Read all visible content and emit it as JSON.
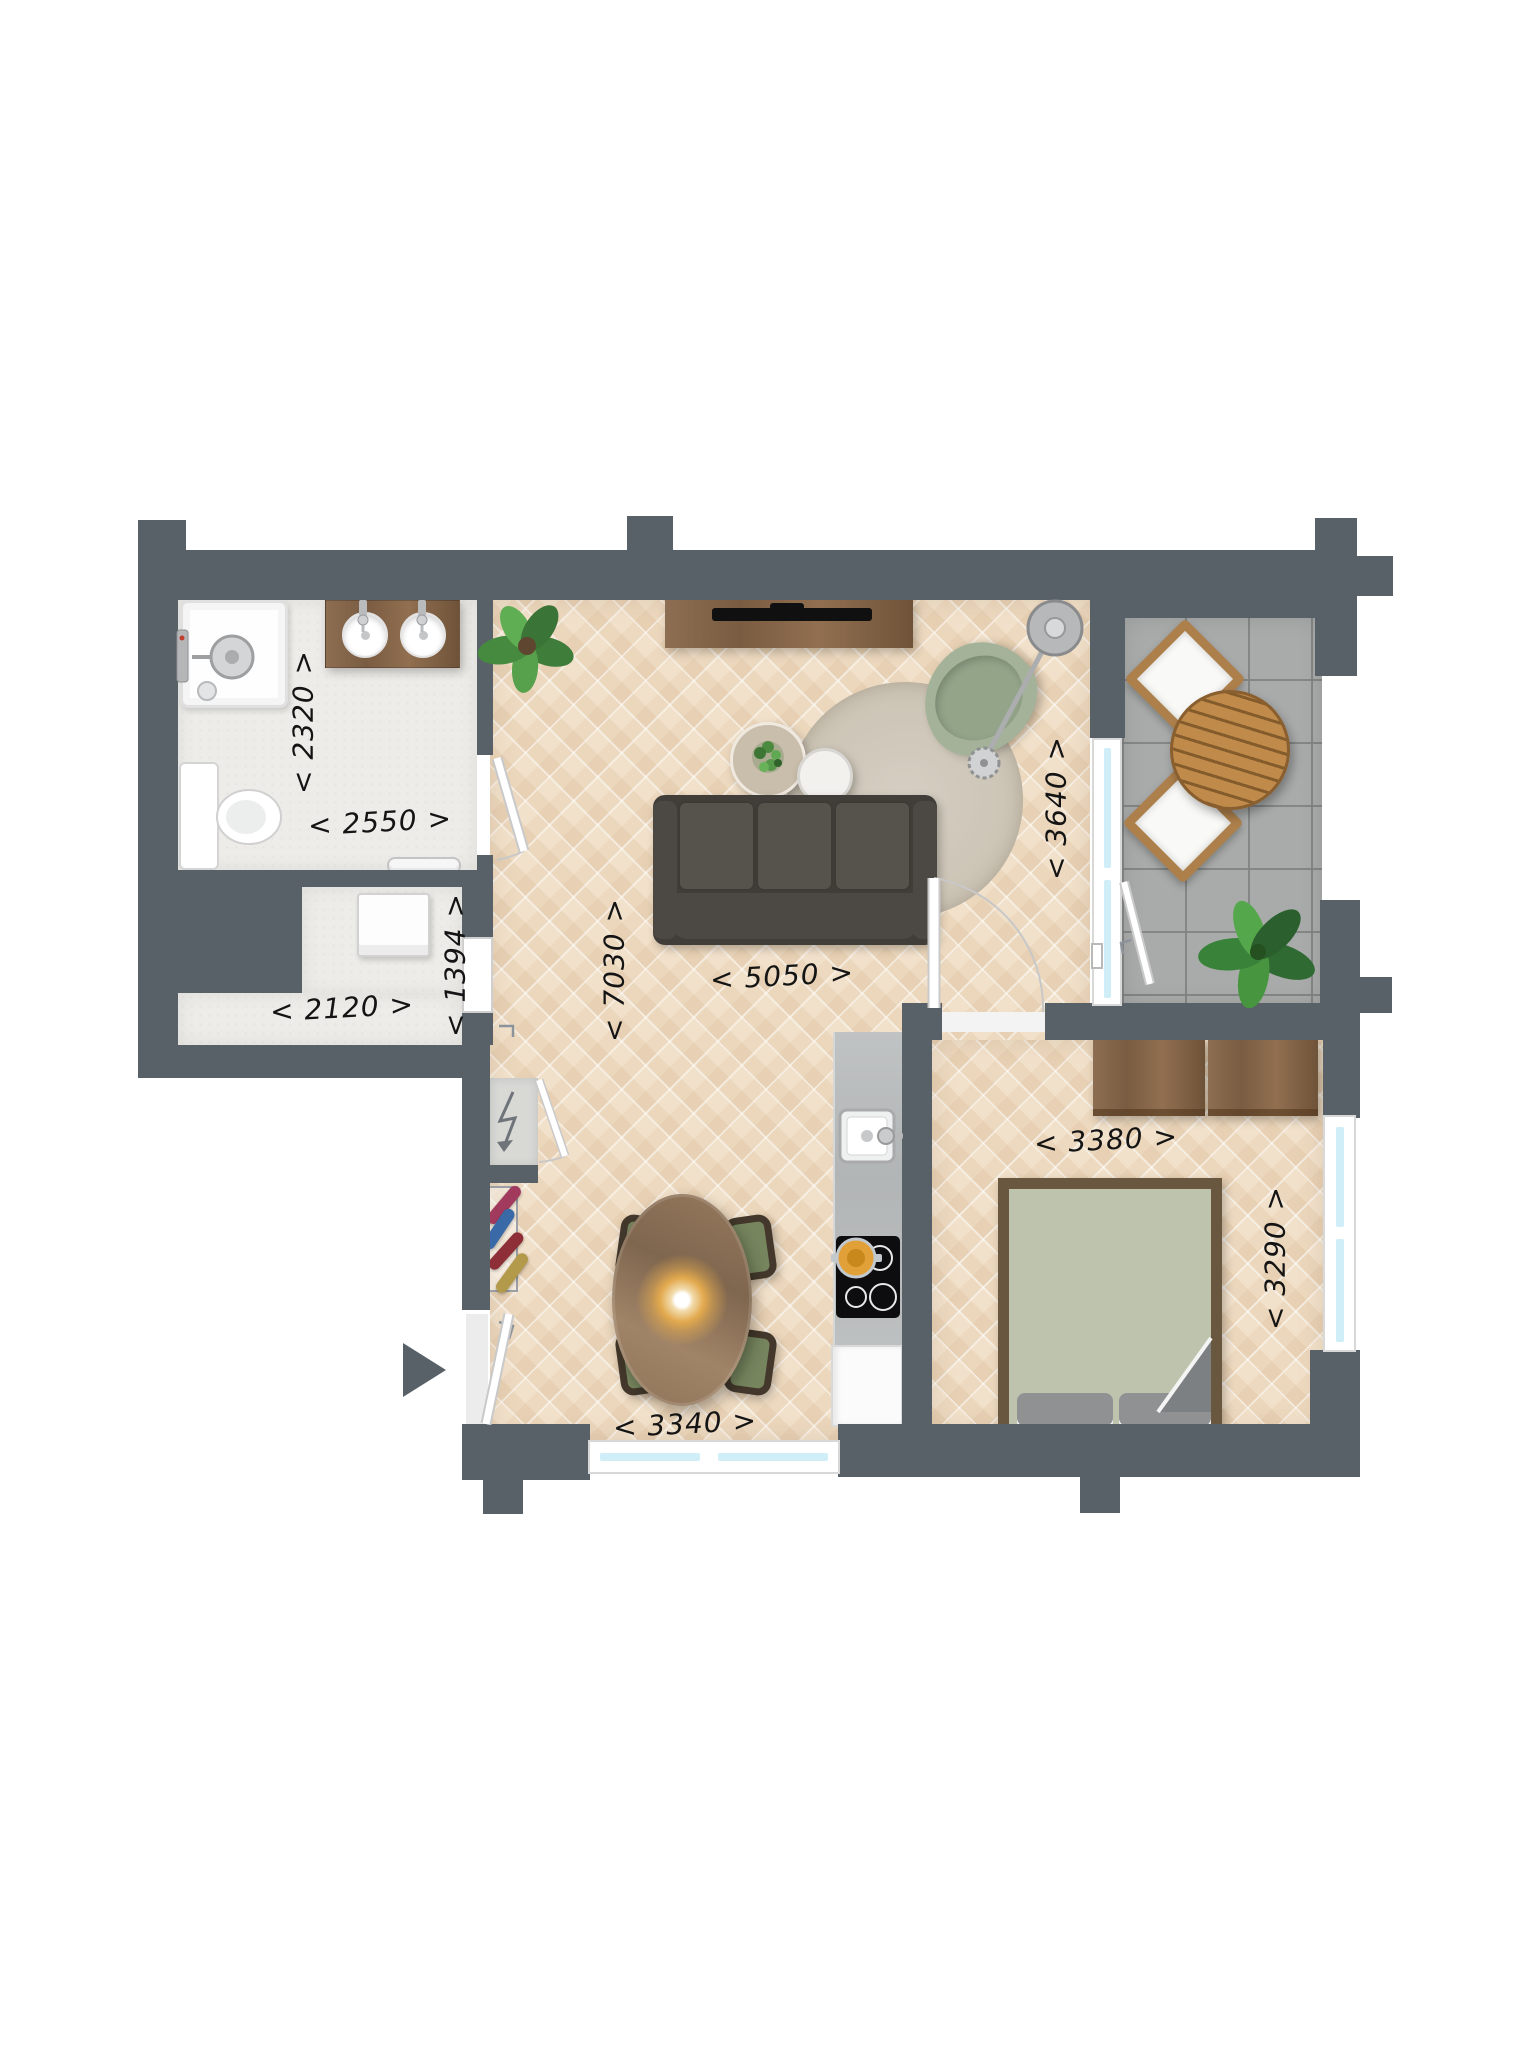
{
  "plan": {
    "type": "architectural-floor-plan",
    "units": "mm",
    "entrance": {
      "icon": "entrance-arrow",
      "direction": "right"
    }
  },
  "dimensions": [
    {
      "room": "bathroom",
      "axis": "width",
      "text": "< 2550 >",
      "value_mm": 2550,
      "orientation": "horizontal"
    },
    {
      "room": "bathroom",
      "axis": "height",
      "text": "< 2320 >",
      "value_mm": 2320,
      "orientation": "vertical"
    },
    {
      "room": "hall",
      "axis": "width",
      "text": "< 2120 >",
      "value_mm": 2120,
      "orientation": "horizontal"
    },
    {
      "room": "hall",
      "axis": "height",
      "text": "< 1394 >",
      "value_mm": 1394,
      "orientation": "vertical"
    },
    {
      "room": "living-room",
      "axis": "height",
      "text": "< 7030 >",
      "value_mm": 7030,
      "orientation": "vertical"
    },
    {
      "room": "living-room",
      "axis": "width",
      "text": "< 5050 >",
      "value_mm": 5050,
      "orientation": "horizontal"
    },
    {
      "room": "living-room-balcony-side",
      "axis": "height",
      "text": "< 3640 >",
      "value_mm": 3640,
      "orientation": "vertical"
    },
    {
      "room": "bedroom",
      "axis": "width",
      "text": "< 3380 >",
      "value_mm": 3380,
      "orientation": "horizontal"
    },
    {
      "room": "bedroom",
      "axis": "height",
      "text": "< 3290 >",
      "value_mm": 3290,
      "orientation": "vertical"
    },
    {
      "room": "dining-area",
      "axis": "width",
      "text": "< 3340 >",
      "value_mm": 3340,
      "orientation": "horizontal"
    }
  ],
  "rooms": [
    {
      "name": "bathroom",
      "furniture": [
        "shower",
        "double-washbasin-vanity",
        "toilet",
        "radiator"
      ]
    },
    {
      "name": "hall",
      "furniture": [
        "washing-machine",
        "coat-rack",
        "meter-cupboard"
      ]
    },
    {
      "name": "living-room",
      "furniture": [
        "tv-sideboard",
        "plant",
        "sofa",
        "round-rug",
        "coffee-tables",
        "armchair",
        "arc-floor-lamp"
      ]
    },
    {
      "name": "kitchen",
      "furniture": [
        "counter-with-sink",
        "induction-hob-with-pan",
        "refrigerator"
      ]
    },
    {
      "name": "dining-area",
      "furniture": [
        "oval-dining-table",
        "four-chairs",
        "pendant-lamp"
      ]
    },
    {
      "name": "bedroom",
      "furniture": [
        "double-bed",
        "two-sideboards"
      ]
    },
    {
      "name": "balcony",
      "furniture": [
        "round-garden-table",
        "two-garden-chairs",
        "plant"
      ]
    }
  ],
  "colors": {
    "wall": "#586068",
    "wood_floor": "#f2e1ca",
    "balcony_tile": "#a9abaa",
    "bathroom_floor": "#edece8",
    "window_glass": "#cfeef7",
    "sofa": "#4a4642",
    "armchair_green": "#a3b298",
    "bed_duvet": "#bdc3ad",
    "dining_seat_green": "#76855e",
    "furniture_wood": "#8d6e52",
    "outdoor_wood": "#b98a52",
    "rug": "#cfc8ba",
    "pan_orange": "#e2a138",
    "label_text": "#141414"
  }
}
